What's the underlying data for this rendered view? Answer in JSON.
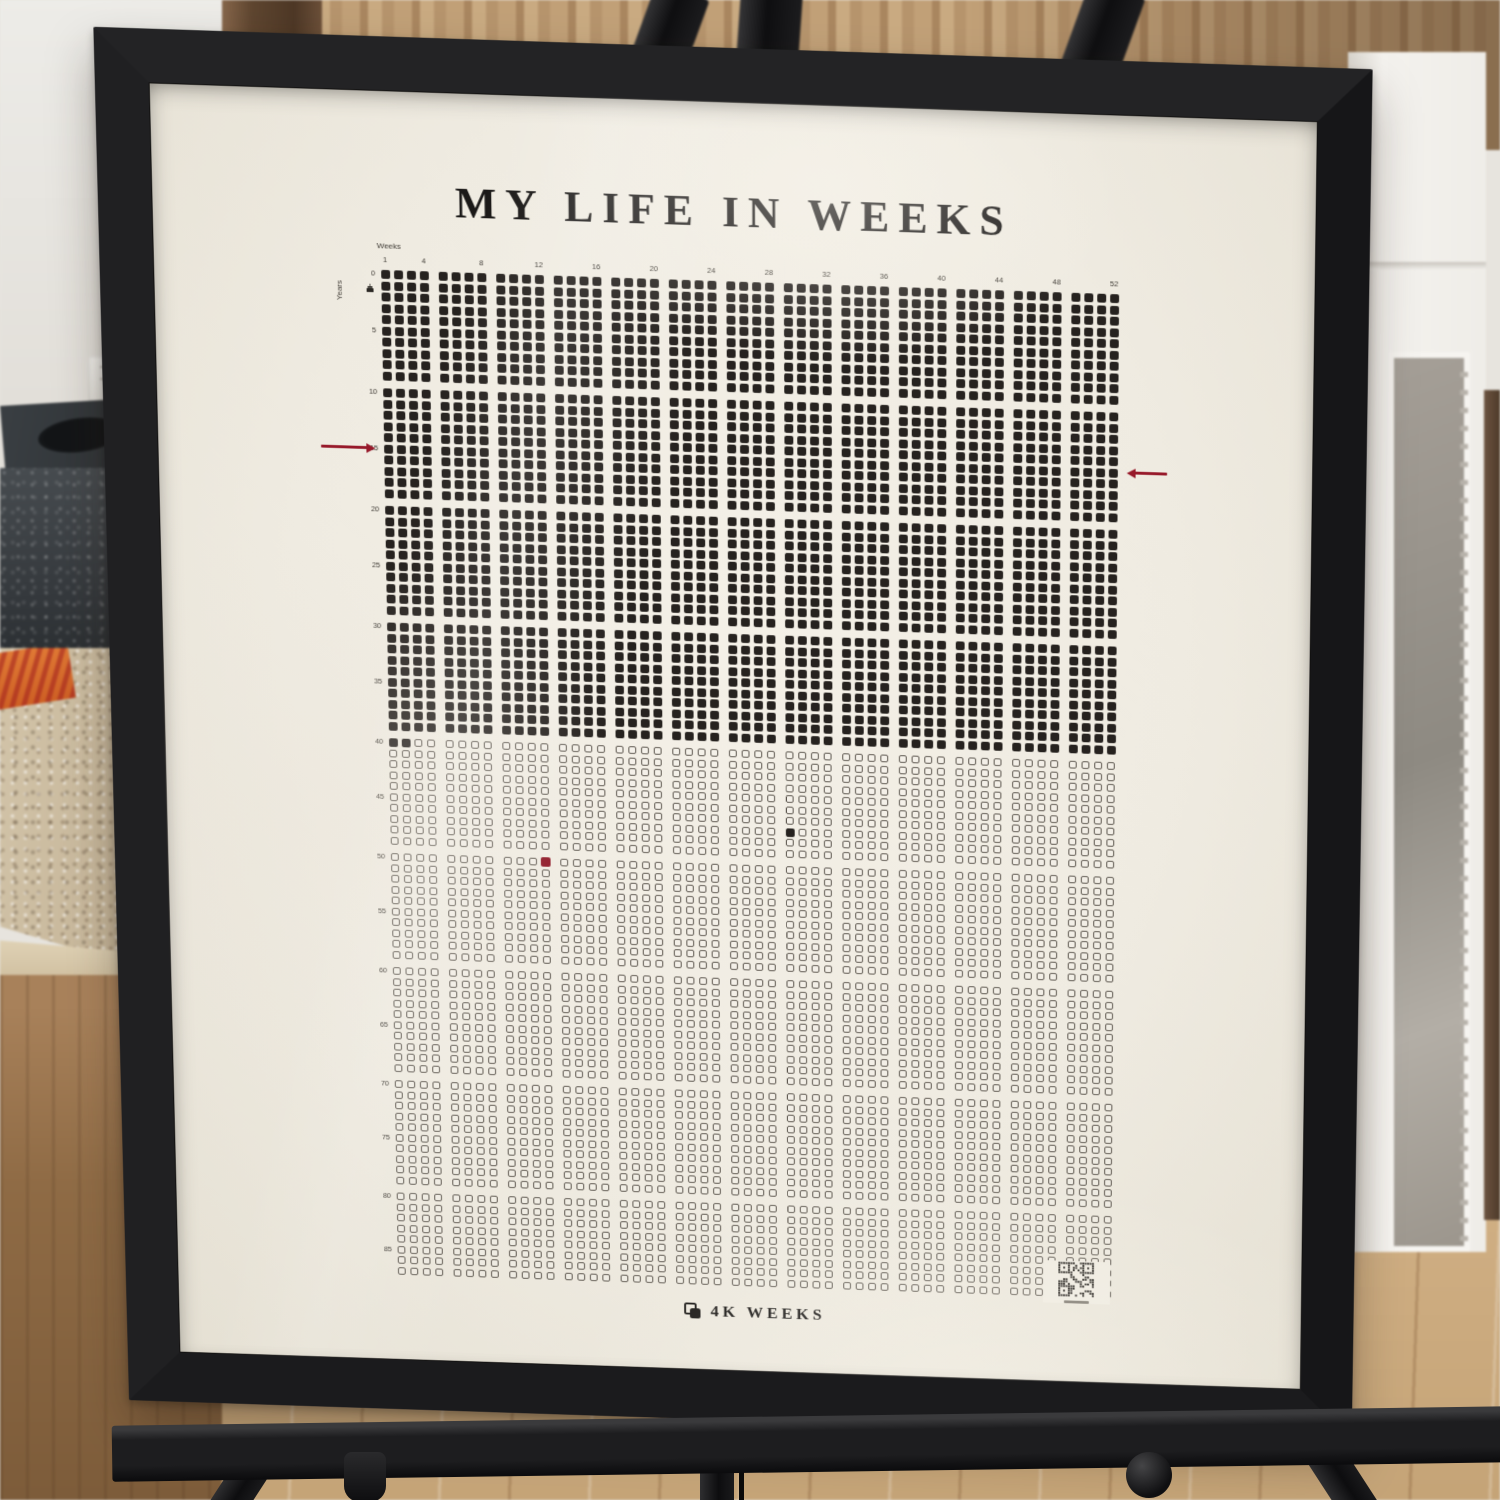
{
  "poster": {
    "title": "MY LIFE IN WEEKS",
    "footer_brand": "4K WEEKS",
    "axes": {
      "x_label": "Weeks",
      "y_label": "Years"
    }
  },
  "chart_data": {
    "type": "heatmap",
    "subtype": "life-calendar-waffle",
    "title": "MY LIFE IN WEEKS",
    "xlabel": "Weeks",
    "ylabel": "Years",
    "columns_weeks": 52,
    "rows_years": 88,
    "x_ticks": [
      1,
      4,
      8,
      12,
      16,
      20,
      24,
      28,
      32,
      36,
      40,
      44,
      48,
      52
    ],
    "y_ticks": [
      0,
      5,
      10,
      15,
      20,
      25,
      30,
      35,
      40,
      45,
      50,
      55,
      60,
      65,
      70,
      75,
      80,
      85
    ],
    "column_group_size": 4,
    "row_group_size": 10,
    "full_years_filled": 40,
    "extra_weeks_in_final_year": 2,
    "filled_weeks_total": 2082,
    "extra_filled_cells": [
      {
        "year": 47,
        "week": 29
      }
    ],
    "highlighted_cell": {
      "year": 50,
      "week": 12,
      "color": "#8e1525"
    },
    "row_marker_arrows": {
      "year": 15,
      "color": "#97192a"
    },
    "birth_marker": {
      "year": 1,
      "icon": "cake-icon"
    },
    "qr_code": {
      "present": true,
      "position": "bottom-right-of-grid"
    },
    "grid_lines": false,
    "legend_position": "none",
    "colors": {
      "ink": "#26221f",
      "empty_outline": "#59534b",
      "paper": "#f0ece3",
      "accent_red": "#8e1525",
      "frame_black": "#1b1b1d"
    }
  }
}
